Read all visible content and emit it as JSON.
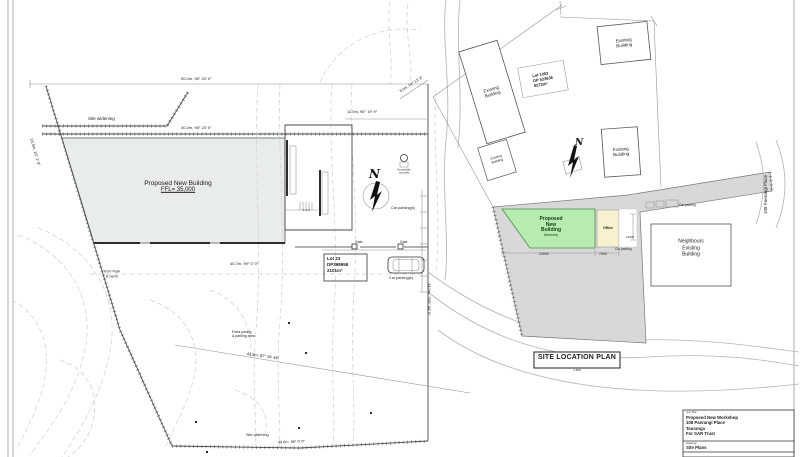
{
  "colors": {
    "building_fill": "#e9ecec",
    "site_fill": "#d8d8d8",
    "workshop_fill": "#b7ecb0",
    "office_fill": "#f7f1cf",
    "line": "#444444"
  },
  "left_plan": {
    "north_letter": "N",
    "building_line1": "Proposed New Building",
    "building_line2": "FFL= 35,000",
    "stair_numbers": "1 2 3",
    "labels": {
      "site_widening_top": "Site widening",
      "site_widening_bottom": "Site widening",
      "bearing_top": "50.0m, 96° 20′ 0″",
      "bearing_upper": "40.2m, 96° 20′ 0″",
      "bearing_top_right": "11.0m, 96° 19′ 9″",
      "bearing_diag_top_right": "8.0m, 54° 13′ 8″",
      "bearing_left_boundary": "24.5m, 16° 1′ 9″",
      "bearing_mid": "45.7m, 99° 0′ 0″",
      "bearing_diag_bottom": "43.8m, 87° 26′ 46″",
      "bearing_bottom": "49.6m, 99° 0′ 0″",
      "bearing_right_boundary": "34.0m, 359° 44′ 0″",
      "hsv_line1": "HSV Park",
      "hsv_line2": "& berm",
      "extra_paving_line1": "Extra paving",
      "extra_paving_line2": "& parking area",
      "car_parking_upper": "Car parking(s)",
      "car_parking_lower": "Car parking(s)",
      "gate_left": "Gate",
      "gate_right": "Gate",
      "accessible_line1": "Accessible",
      "accessible_line2": "car park"
    },
    "lot_box": {
      "line1": "Lot 23",
      "line2": "DP398958",
      "line3": "2101m²"
    }
  },
  "location_plan": {
    "title": "SITE LOCATION PLAN",
    "scale": "1:500",
    "north_letter": "N",
    "existing_line1": "Existing",
    "existing_line2": "Building",
    "lot_box": {
      "line1": "Lot 1002",
      "line2": "DP 523636",
      "line3": "8572m²"
    },
    "workshop": {
      "line1": "Proposed",
      "line2": "New",
      "line3": "Building",
      "line4": "Workshop"
    },
    "office_label": "Office",
    "neighbours": {
      "line1": "Neighbours",
      "line2": "Existing",
      "line3": "Building"
    },
    "car_parking_arm": "Car parking",
    "car_parking_inner": "Car parking",
    "street_label": "108 Paerangi Place",
    "dims": {
      "width": "24000",
      "office": "7000",
      "depth": "11000"
    }
  },
  "title_block": {
    "job_label": "Job Title:",
    "project_line1": "Proposed New Workshop",
    "project_line2": "108 Paerangi Place",
    "project_line3": "Tauranga",
    "project_line4": "For SAR Trust",
    "drawing_label": "Drawing:",
    "drawing_name": "Site Plans"
  }
}
